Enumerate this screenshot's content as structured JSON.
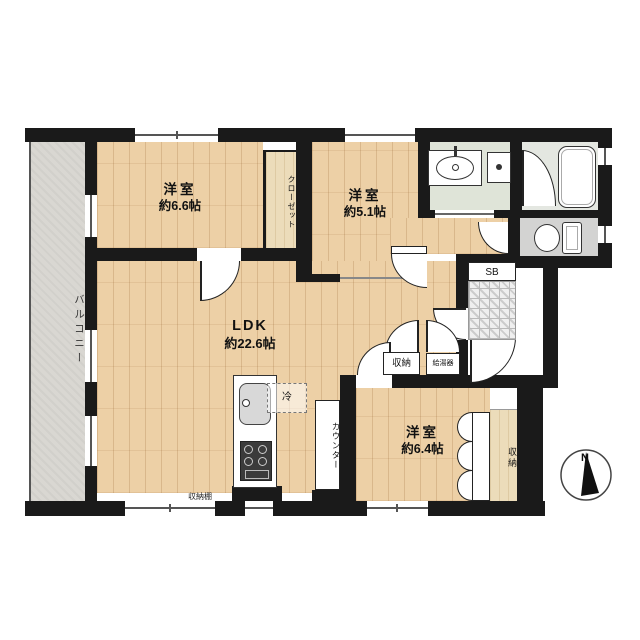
{
  "title": "apartment-floor-plan",
  "colors": {
    "wall": "#1a1a1a",
    "wood_floor": "#edd0a6",
    "balcony": "#d9d7d2",
    "washroom": "#dfe4d8",
    "bathroom": "#e4e7e1",
    "toilet": "#d3d3d2",
    "closet": "#ecdcba"
  },
  "rooms": {
    "balcony": {
      "label": "バルコニー"
    },
    "bedroom1": {
      "label": "洋室",
      "size": "約6.6帖"
    },
    "closet": {
      "label": "クローゼット"
    },
    "bedroom2": {
      "label": "洋室",
      "size": "約5.1帖"
    },
    "ldk": {
      "label": "LDK",
      "size": "約22.6帖"
    },
    "bedroom3": {
      "label": "洋室",
      "size": "約6.4帖"
    }
  },
  "labels": {
    "storage_hall": "収納",
    "water_heater": "給湯器",
    "shaft_box": "SB",
    "refrigerator": "冷",
    "counter": "カウンター",
    "storage_shelf": "収納棚",
    "storage_bedroom3": "収納",
    "compass_north": "N"
  }
}
